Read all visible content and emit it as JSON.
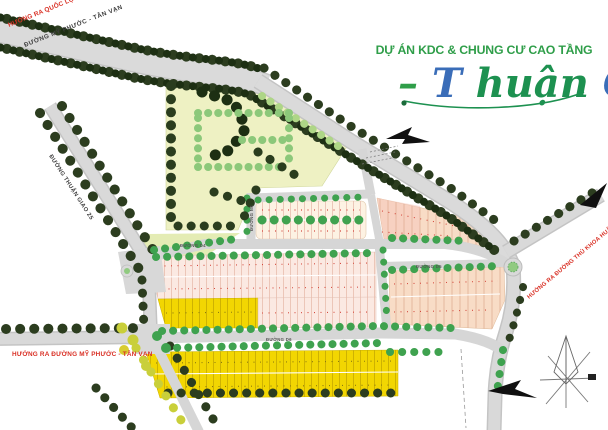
{
  "title": {
    "line1": "DỰ ÁN KDC & CHUNG CƯ CAO TẦNG",
    "logo": {
      "dash": "–",
      "t": "T",
      "huan": "huận ",
      "g": "G",
      "iao": "iao"
    }
  },
  "roads": {
    "my_phuoc_tan_van": "ĐƯỜNG MỸ PHƯỚC - TÂN VẠN",
    "thuan_giao_25": "ĐƯỜNG THUẬN GIAO 25",
    "d4": "ĐƯỜNG D4",
    "d5": "ĐƯỜNG D5",
    "d6": "ĐƯỜNG D6",
    "n4": "ĐƯỜNG N4"
  },
  "directions": {
    "quoc_lo_13": "HƯỚNG RA QUỐC LỘ 13",
    "my_phuoc_tan_van": "HƯỚNG RA ĐƯỜNG MỸ PHƯỚC - TÂN VẠN",
    "thu_khoa_huan": "HƯỚNG RA ĐƯỜNG THỦ KHOA HUÂN"
  },
  "colors": {
    "accent_green": "#2f9e49",
    "logo_green": "#1d9150",
    "logo_blue": "#3a6db8",
    "warning_red": "#d93025"
  }
}
